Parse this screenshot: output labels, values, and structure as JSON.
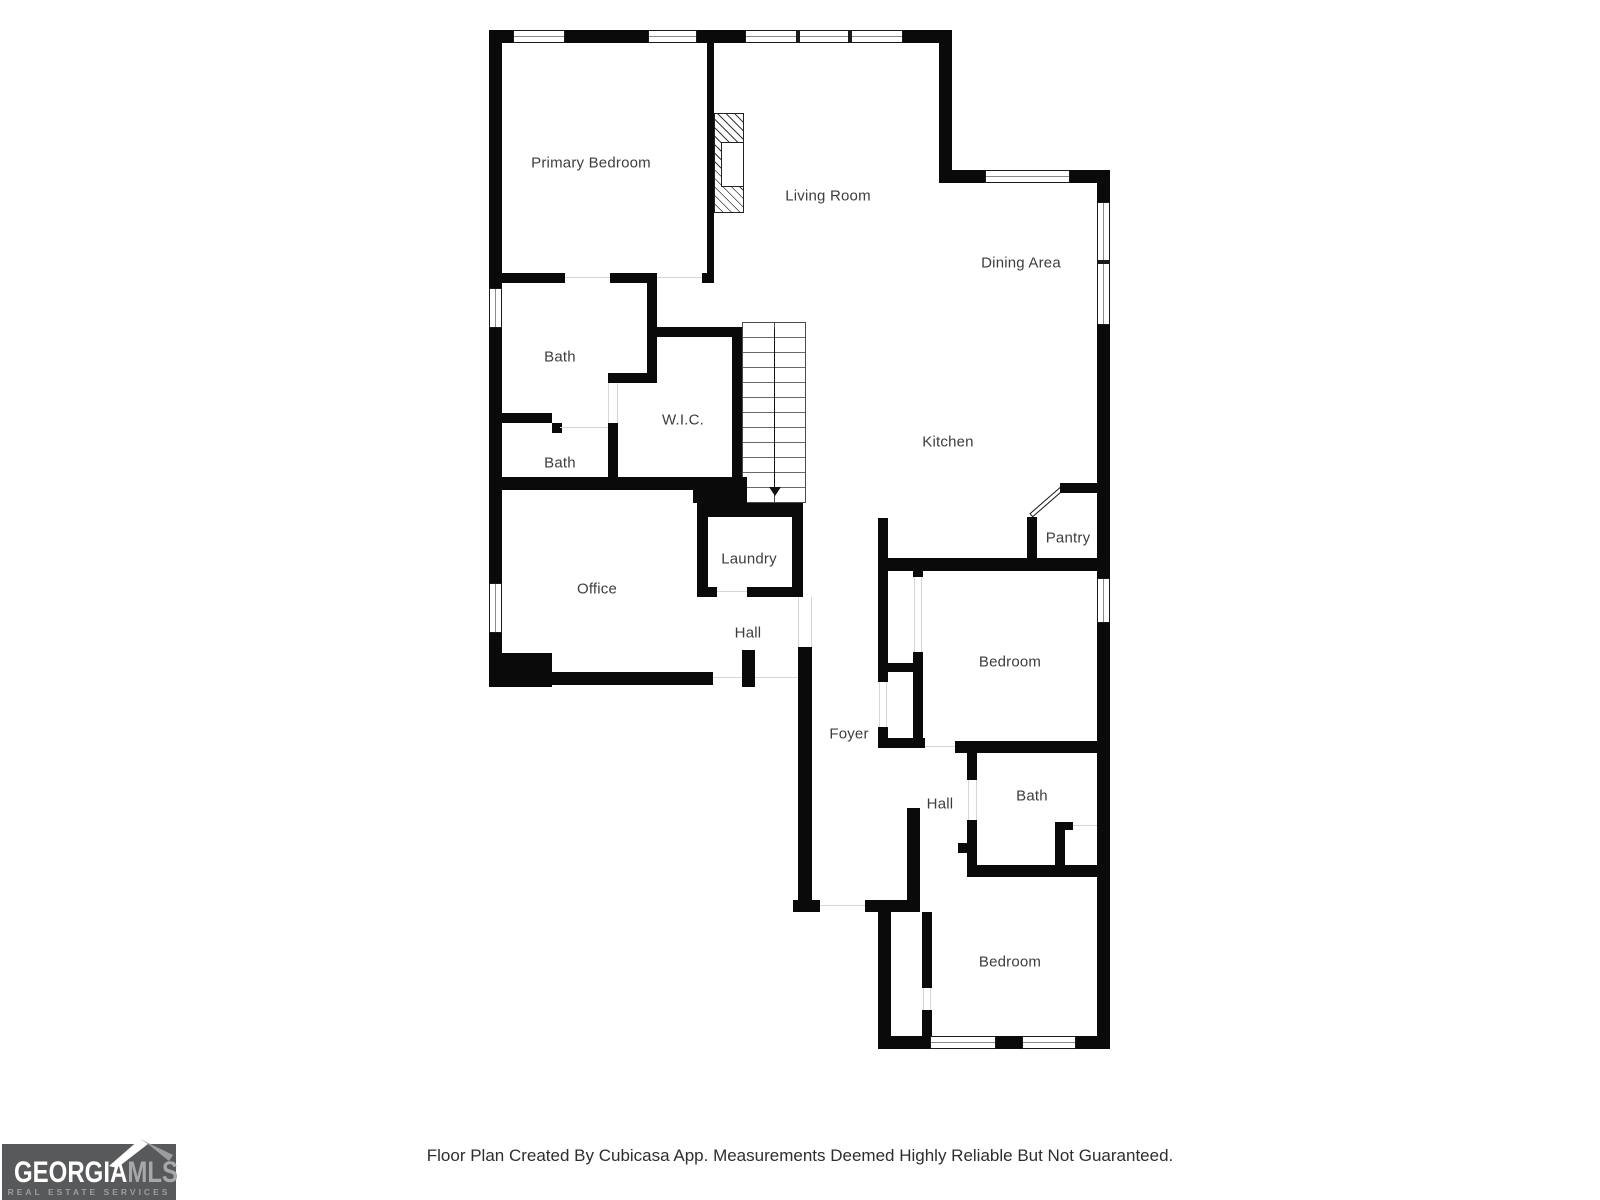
{
  "floor_plan": {
    "rooms": [
      {
        "label": "Primary Bedroom"
      },
      {
        "label": "Living Room"
      },
      {
        "label": "Dining Area"
      },
      {
        "label": "Bath"
      },
      {
        "label": "W.I.C."
      },
      {
        "label": "Bath"
      },
      {
        "label": "Kitchen"
      },
      {
        "label": "Pantry"
      },
      {
        "label": "Laundry"
      },
      {
        "label": "Office"
      },
      {
        "label": "Hall"
      },
      {
        "label": "Bedroom"
      },
      {
        "label": "Foyer"
      },
      {
        "label": "Hall"
      },
      {
        "label": "Bath"
      },
      {
        "label": "Bedroom"
      }
    ]
  },
  "logo": {
    "brand_primary": "GEORGIA",
    "brand_secondary": "MLS",
    "tagline": "REAL ESTATE SERVICES"
  },
  "footer": {
    "disclaimer": "Floor Plan Created By Cubicasa App. Measurements Deemed Highly Reliable But Not Guaranteed."
  },
  "colors": {
    "wall": "#0a0a0a",
    "label_text": "#3d3d3d",
    "door_opening": "#d6d6d6",
    "logo_background": "#58595b",
    "logo_primary_text": "#ffffff",
    "logo_secondary_text": "#a6a8ab",
    "logo_tagline_text": "#9b9da0",
    "footer_text": "#2e2e2e"
  }
}
